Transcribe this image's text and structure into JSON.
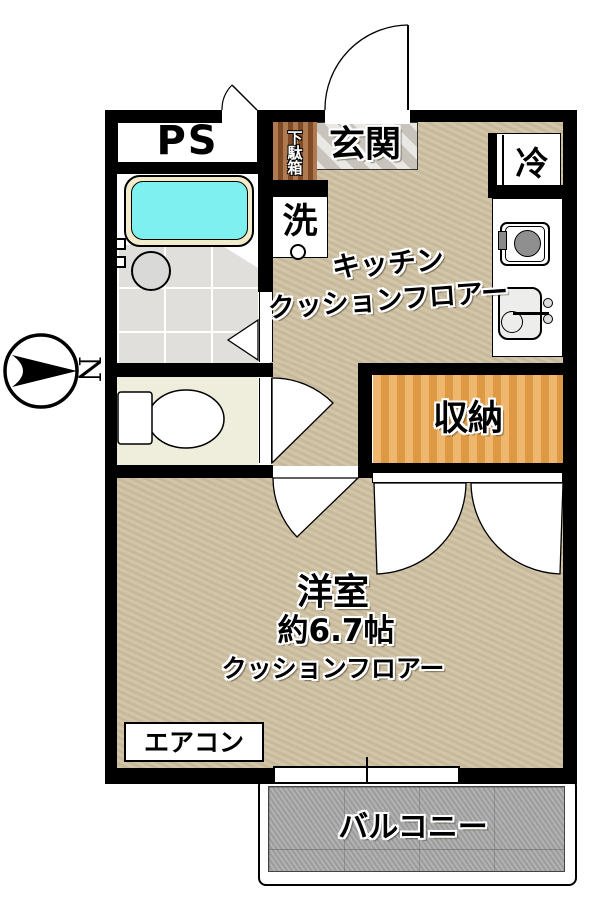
{
  "title": "apartment floor plan",
  "compass": {
    "north_label": "N"
  },
  "rooms": {
    "ps_label": "PS",
    "genkan_label": "玄関",
    "shoe_cabinet_label": "下駄箱",
    "washer_label": "洗",
    "fridge_label": "冷",
    "kitchen_line1": "キッチン",
    "kitchen_line2": "クッションフロアー",
    "storage_label": "収納",
    "western_room_line1": "洋室",
    "western_room_line2": "約6.7帖",
    "western_room_line3": "クッションフロアー",
    "aircon_label": "エアコン",
    "balcony_label": "バルコニー"
  },
  "colors": {
    "wall": "#000000",
    "floor-tan": "#cfc1a2",
    "tub-water": "#7ef0ef",
    "tub-rim": "#f2ecca",
    "bath-floor": "#e0dfdc",
    "toilet-floor": "#efeedd",
    "stone": "#d9d6cf",
    "wood-brown": "#95592f",
    "storage-orange": "#eca74e",
    "concrete": "#a9a9a9"
  }
}
